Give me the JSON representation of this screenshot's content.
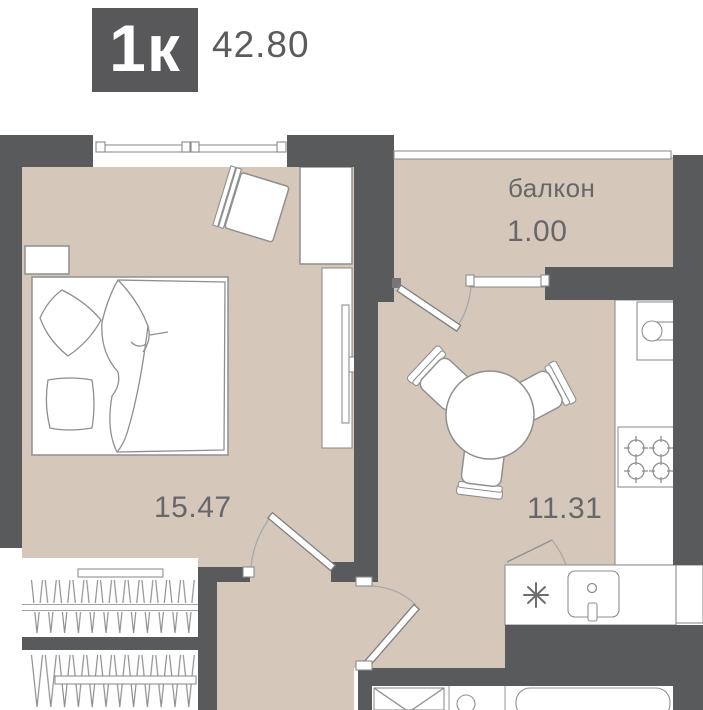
{
  "header": {
    "badge_label": "1к",
    "area_value": "42.80"
  },
  "rooms": {
    "balcony": {
      "label": "балкон",
      "area": "1.00"
    },
    "bedroom": {
      "area": "15.47"
    },
    "kitchen": {
      "area": "11.31"
    }
  },
  "icons": {
    "fridge": "snowflake-icon"
  },
  "colors": {
    "wall": "#595a5c",
    "floor": "#d5c8bb",
    "badge_bg": "#58585a",
    "badge_text": "#ffffff",
    "outline": "#8f8f8f",
    "thin_line": "#a2a2a2",
    "label": "#67676a",
    "page_bg": "#ffffff"
  }
}
